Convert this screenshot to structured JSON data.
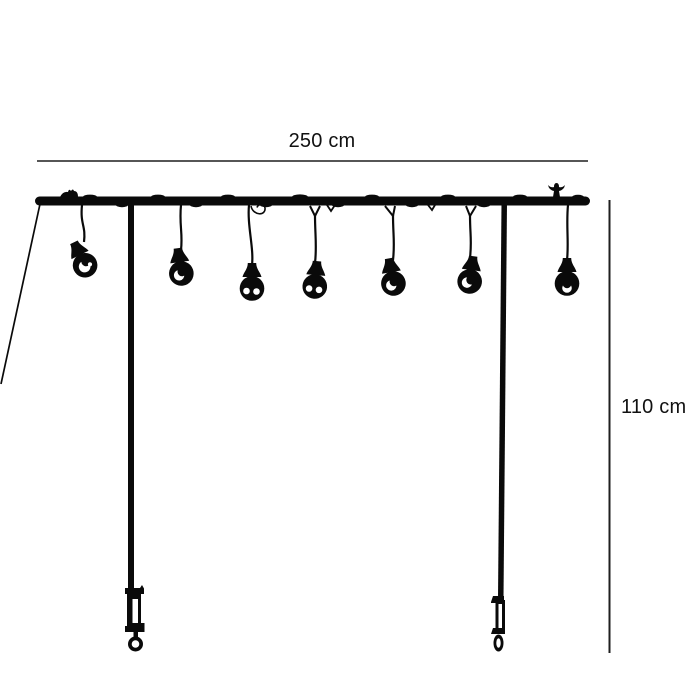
{
  "diagram": {
    "description": "Black silhouette product dimension diagram of a string-light garland strung on a bar supported by two poles with table screw clamps",
    "width_dimension_label": "250 cm",
    "height_dimension_label": "110 cm",
    "bulb_count": 7,
    "bulbs": [
      {
        "hang_x": 82,
        "x": 84,
        "y": 263,
        "tilt": -26,
        "variant": "swirl",
        "fork": false
      },
      {
        "hang_x": 181,
        "x": 181,
        "y": 271,
        "tilt": -8,
        "variant": "crescent",
        "fork": false
      },
      {
        "hang_x": 249,
        "x": 252,
        "y": 286,
        "tilt": 0,
        "variant": "dots",
        "fork": false
      },
      {
        "hang_x": 315,
        "x": 315,
        "y": 284,
        "tilt": 5,
        "variant": "dots",
        "fork": true
      },
      {
        "hang_x": 390,
        "x": 393,
        "y": 281,
        "tilt": -10,
        "variant": "crescent",
        "fork": true
      },
      {
        "hang_x": 471,
        "x": 470,
        "y": 279,
        "tilt": 8,
        "variant": "crescent",
        "fork": true
      },
      {
        "hang_x": 568,
        "x": 567,
        "y": 281,
        "tilt": 0,
        "variant": "bottom",
        "fork": false
      }
    ],
    "colors": {
      "silhouette": "#0a0a0a",
      "dimension_line": "#1f1f1f",
      "label_text": "#111111",
      "background": "#ffffff"
    }
  }
}
